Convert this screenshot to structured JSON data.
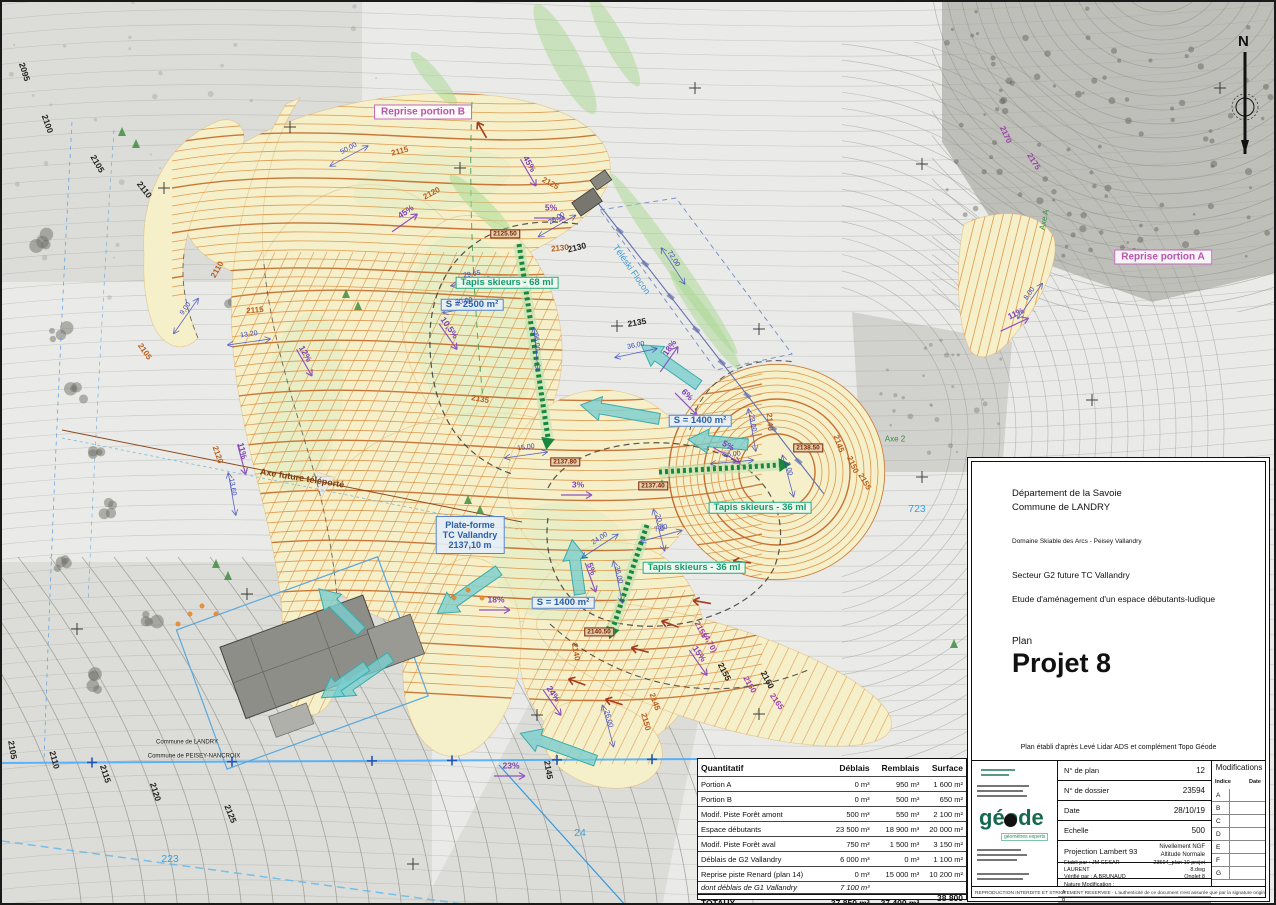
{
  "map": {
    "north_label": "N",
    "platform_label": {
      "lines": [
        "Plate-forme",
        "TC Vallandry",
        "2137,10 m"
      ],
      "x": 468,
      "y": 533
    },
    "labels": [
      [
        "Reprise portion B",
        421,
        110,
        0,
        "pink-box"
      ],
      [
        "Reprise portion A",
        1161,
        255,
        0,
        "pink-box"
      ],
      [
        "Tapis skieurs - 68 ml",
        505,
        281,
        0,
        "green-box"
      ],
      [
        "Tapis skieurs - 36 ml",
        758,
        506,
        0,
        "green-box"
      ],
      [
        "Tapis skieurs - 36 ml",
        692,
        566,
        0,
        "green-box"
      ],
      [
        "S = 2500 m²",
        470,
        303,
        0,
        "blue-box"
      ],
      [
        "S = 1400 m²",
        698,
        419,
        0,
        "blue-box"
      ],
      [
        "S = 1400 m²",
        561,
        601,
        0,
        "blue-box"
      ],
      [
        "2125.50",
        503,
        232,
        0,
        "red-box"
      ],
      [
        "2137.80",
        563,
        460,
        0,
        "red-box"
      ],
      [
        "2137.40",
        651,
        484,
        0,
        "red-box"
      ],
      [
        "2138.50",
        806,
        446,
        0,
        "red-box"
      ],
      [
        "2140.50",
        597,
        630,
        0,
        "red-box"
      ],
      [
        "45%",
        404,
        210,
        -35,
        "purple"
      ],
      [
        "45%",
        527,
        162,
        60,
        "purple"
      ],
      [
        "5%",
        549,
        206,
        0,
        "purple"
      ],
      [
        "10,5%",
        447,
        326,
        55,
        "purple"
      ],
      [
        "3%",
        576,
        483,
        0,
        "purple"
      ],
      [
        "5%",
        589,
        567,
        70,
        "purple"
      ],
      [
        "5%",
        726,
        444,
        30,
        "purple"
      ],
      [
        "6%",
        685,
        393,
        45,
        "purple"
      ],
      [
        "18%",
        668,
        346,
        -55,
        "purple"
      ],
      [
        "18%",
        494,
        598,
        0,
        "purple"
      ],
      [
        "23%",
        509,
        764,
        0,
        "purple"
      ],
      [
        "24%",
        551,
        692,
        55,
        "purple"
      ],
      [
        "15%",
        697,
        652,
        55,
        "purple"
      ],
      [
        "11%",
        240,
        449,
        75,
        "purple"
      ],
      [
        "12%",
        303,
        352,
        60,
        "purple"
      ],
      [
        "11%",
        1014,
        312,
        -25,
        "purple"
      ],
      [
        "26,00",
        555,
        217,
        -30,
        "dim"
      ],
      [
        "29,65",
        470,
        273,
        -10,
        "dim"
      ],
      [
        "30,00",
        462,
        300,
        -10,
        "dim"
      ],
      [
        "66,00",
        534,
        340,
        85,
        "dim"
      ],
      [
        "15,00",
        524,
        446,
        -8,
        "dim"
      ],
      [
        "72,00",
        671,
        257,
        57,
        "dim"
      ],
      [
        "36,00",
        634,
        344,
        -12,
        "dim"
      ],
      [
        "23,00",
        750,
        421,
        80,
        "dim"
      ],
      [
        "36,00",
        730,
        453,
        -5,
        "dim"
      ],
      [
        "2,00",
        786,
        467,
        75,
        "dim"
      ],
      [
        "20,00",
        657,
        521,
        75,
        "dim"
      ],
      [
        "7,00",
        659,
        527,
        -15,
        "dim"
      ],
      [
        "24,00",
        598,
        537,
        -33,
        "dim"
      ],
      [
        "36,00",
        616,
        573,
        78,
        "dim"
      ],
      [
        "26,00",
        606,
        717,
        75,
        "dim"
      ],
      [
        "13,20",
        247,
        333,
        -8,
        "dim"
      ],
      [
        "13,60",
        230,
        485,
        80,
        "dim"
      ],
      [
        "9,00",
        184,
        307,
        -55,
        "dim"
      ],
      [
        "8,00",
        1028,
        292,
        -55,
        "dim"
      ],
      [
        "50,00",
        347,
        147,
        -28,
        "dim"
      ],
      [
        "2095",
        22,
        70,
        72,
        "contour-black"
      ],
      [
        "2100",
        45,
        122,
        70,
        "contour-black"
      ],
      [
        "2105",
        95,
        162,
        60,
        "contour-black"
      ],
      [
        "2110",
        142,
        188,
        52,
        "contour-black"
      ],
      [
        "2105",
        10,
        748,
        80,
        "contour-black"
      ],
      [
        "2110",
        52,
        758,
        75,
        "contour-black"
      ],
      [
        "2115",
        103,
        772,
        72,
        "contour-black"
      ],
      [
        "2120",
        153,
        790,
        72,
        "contour-black"
      ],
      [
        "2125",
        228,
        812,
        68,
        "contour-black"
      ],
      [
        "2130",
        575,
        246,
        -14,
        "contour-black"
      ],
      [
        "2135",
        635,
        321,
        -10,
        "contour-black"
      ],
      [
        "2145",
        546,
        768,
        80,
        "contour-black"
      ],
      [
        "2155",
        722,
        670,
        63,
        "contour-black"
      ],
      [
        "2160",
        765,
        678,
        62,
        "contour-black"
      ],
      [
        "2125",
        930,
        848,
        60,
        "contour-black"
      ],
      [
        "2115",
        398,
        150,
        -15,
        "contour-orange"
      ],
      [
        "2120",
        430,
        192,
        -28,
        "contour-orange"
      ],
      [
        "2125",
        548,
        182,
        28,
        "contour-orange"
      ],
      [
        "2130",
        558,
        247,
        -6,
        "contour-orange"
      ],
      [
        "2110",
        216,
        268,
        -60,
        "contour-orange"
      ],
      [
        "2115",
        253,
        309,
        -5,
        "contour-orange"
      ],
      [
        "2105",
        142,
        350,
        55,
        "contour-orange"
      ],
      [
        "2120",
        215,
        453,
        70,
        "contour-orange"
      ],
      [
        "2140",
        767,
        420,
        85,
        "contour-orange"
      ],
      [
        "2145",
        836,
        442,
        70,
        "contour-orange"
      ],
      [
        "2150",
        850,
        463,
        66,
        "contour-orange"
      ],
      [
        "2155",
        862,
        480,
        60,
        "contour-orange"
      ],
      [
        "2140",
        573,
        650,
        80,
        "contour-orange"
      ],
      [
        "2150",
        643,
        720,
        75,
        "contour-orange"
      ],
      [
        "2135",
        478,
        398,
        10,
        "contour-orange"
      ],
      [
        "2145",
        652,
        700,
        70,
        "contour-orange"
      ],
      [
        "2155",
        698,
        628,
        62,
        "contour-purple"
      ],
      [
        "(4,70)",
        707,
        641,
        62,
        "contour-purple"
      ],
      [
        "2160",
        747,
        683,
        60,
        "contour-purple"
      ],
      [
        "2165",
        774,
        700,
        55,
        "contour-purple"
      ],
      [
        "2170",
        1003,
        133,
        65,
        "contour-purple"
      ],
      [
        "2175",
        1031,
        160,
        58,
        "contour-purple"
      ],
      [
        "723",
        915,
        508,
        0,
        "parcel"
      ],
      [
        "223",
        168,
        858,
        0,
        "parcel"
      ],
      [
        "24",
        578,
        832,
        0,
        "parcel"
      ],
      [
        "Téléski Flocon",
        629,
        268,
        55,
        "lightblue"
      ],
      [
        "Axe future téléporté",
        300,
        477,
        9,
        "brown"
      ],
      [
        "Axe 2",
        893,
        438,
        0,
        "green-axis"
      ],
      [
        "Axe A",
        1043,
        218,
        -78,
        "green-axis"
      ],
      [
        "Commune de LANDRY",
        185,
        741,
        0,
        "tiny-black"
      ],
      [
        "Commune de PEISEY-NANCROIX",
        192,
        755,
        0,
        "tiny-black"
      ]
    ]
  },
  "quantity_table": {
    "headers": [
      "Quantitatif",
      "Déblais",
      "Remblais",
      "Surface"
    ],
    "rows": [
      [
        "Portion A",
        "0 m³",
        "950 m³",
        "1 600 m²"
      ],
      [
        "Portion B",
        "0 m³",
        "500 m³",
        "650 m²"
      ],
      [
        "Modif. Piste Forêt amont",
        "500 m³",
        "550 m³",
        "2 100 m²"
      ],
      [
        "Espace débutants",
        "23 500 m³",
        "18 900 m³",
        "20 000 m²"
      ],
      [
        "Modif. Piste Forêt aval",
        "750 m³",
        "1 500 m³",
        "3 150 m²"
      ],
      [
        "Déblais de G2 Vallandry",
        "6 000 m³",
        "0 m³",
        "1 100 m²"
      ],
      [
        "Reprise piste Renard (plan 14)",
        "0 m³",
        "15 000 m³",
        "10 200 m²"
      ]
    ],
    "subrow": [
      "dont déblais de G1 Vallandry",
      "7 100 m³",
      "",
      ""
    ],
    "total": [
      "TOTAUX",
      "37 850 m³",
      "37 400 m³",
      "38 800 m²"
    ]
  },
  "title_block": {
    "department": "Département de la Savoie",
    "commune": "Commune de LANDRY",
    "domain": "Domaine Skiable des Arcs - Peisey Vallandry",
    "sector": "Secteur G2 future TC Vallandry",
    "study": "Etude d'aménagement d'un espace débutants-ludique",
    "plan_label": "Plan",
    "plan_name": "Projet 8",
    "source_note": "Plan établi d'après Levé Lidar ADS et complément Topo Géode",
    "logo_text": "géode",
    "logo_subtext": "géomètres experts",
    "fields": [
      {
        "label": "N° de plan",
        "value": "12"
      },
      {
        "label": "N° de dossier",
        "value": "23594"
      },
      {
        "label": "Date",
        "value": "28/10/19"
      },
      {
        "label": "Echelle",
        "value": "500"
      }
    ],
    "projection_label": "Projection Lambert 93",
    "levelling": "Nivellement NGF",
    "levelling2": "Altitude Normale",
    "etabli": "Etabli par : JM CESAR-LAURENT",
    "verifie": "Vérifié par : A.BRUNAUD",
    "file_name": "23594_plan 10 projet 8.dwg",
    "file_tab": "Onglet 8",
    "nature_label": "Nature Modification :",
    "nature_rows": [
      "A",
      "B",
      "C"
    ],
    "modifications": {
      "title": "Modifications",
      "col1": "Indice",
      "col2": "Date",
      "rows": [
        "A",
        "B",
        "C",
        "D",
        "E",
        "F",
        "G"
      ]
    },
    "footer": "REPRODUCTION INTERDITE ET STRICTEMENT RESERVEE - L'authenticité de ce document n'est assurée que par la signature originale du Géomètre-Expert."
  }
}
